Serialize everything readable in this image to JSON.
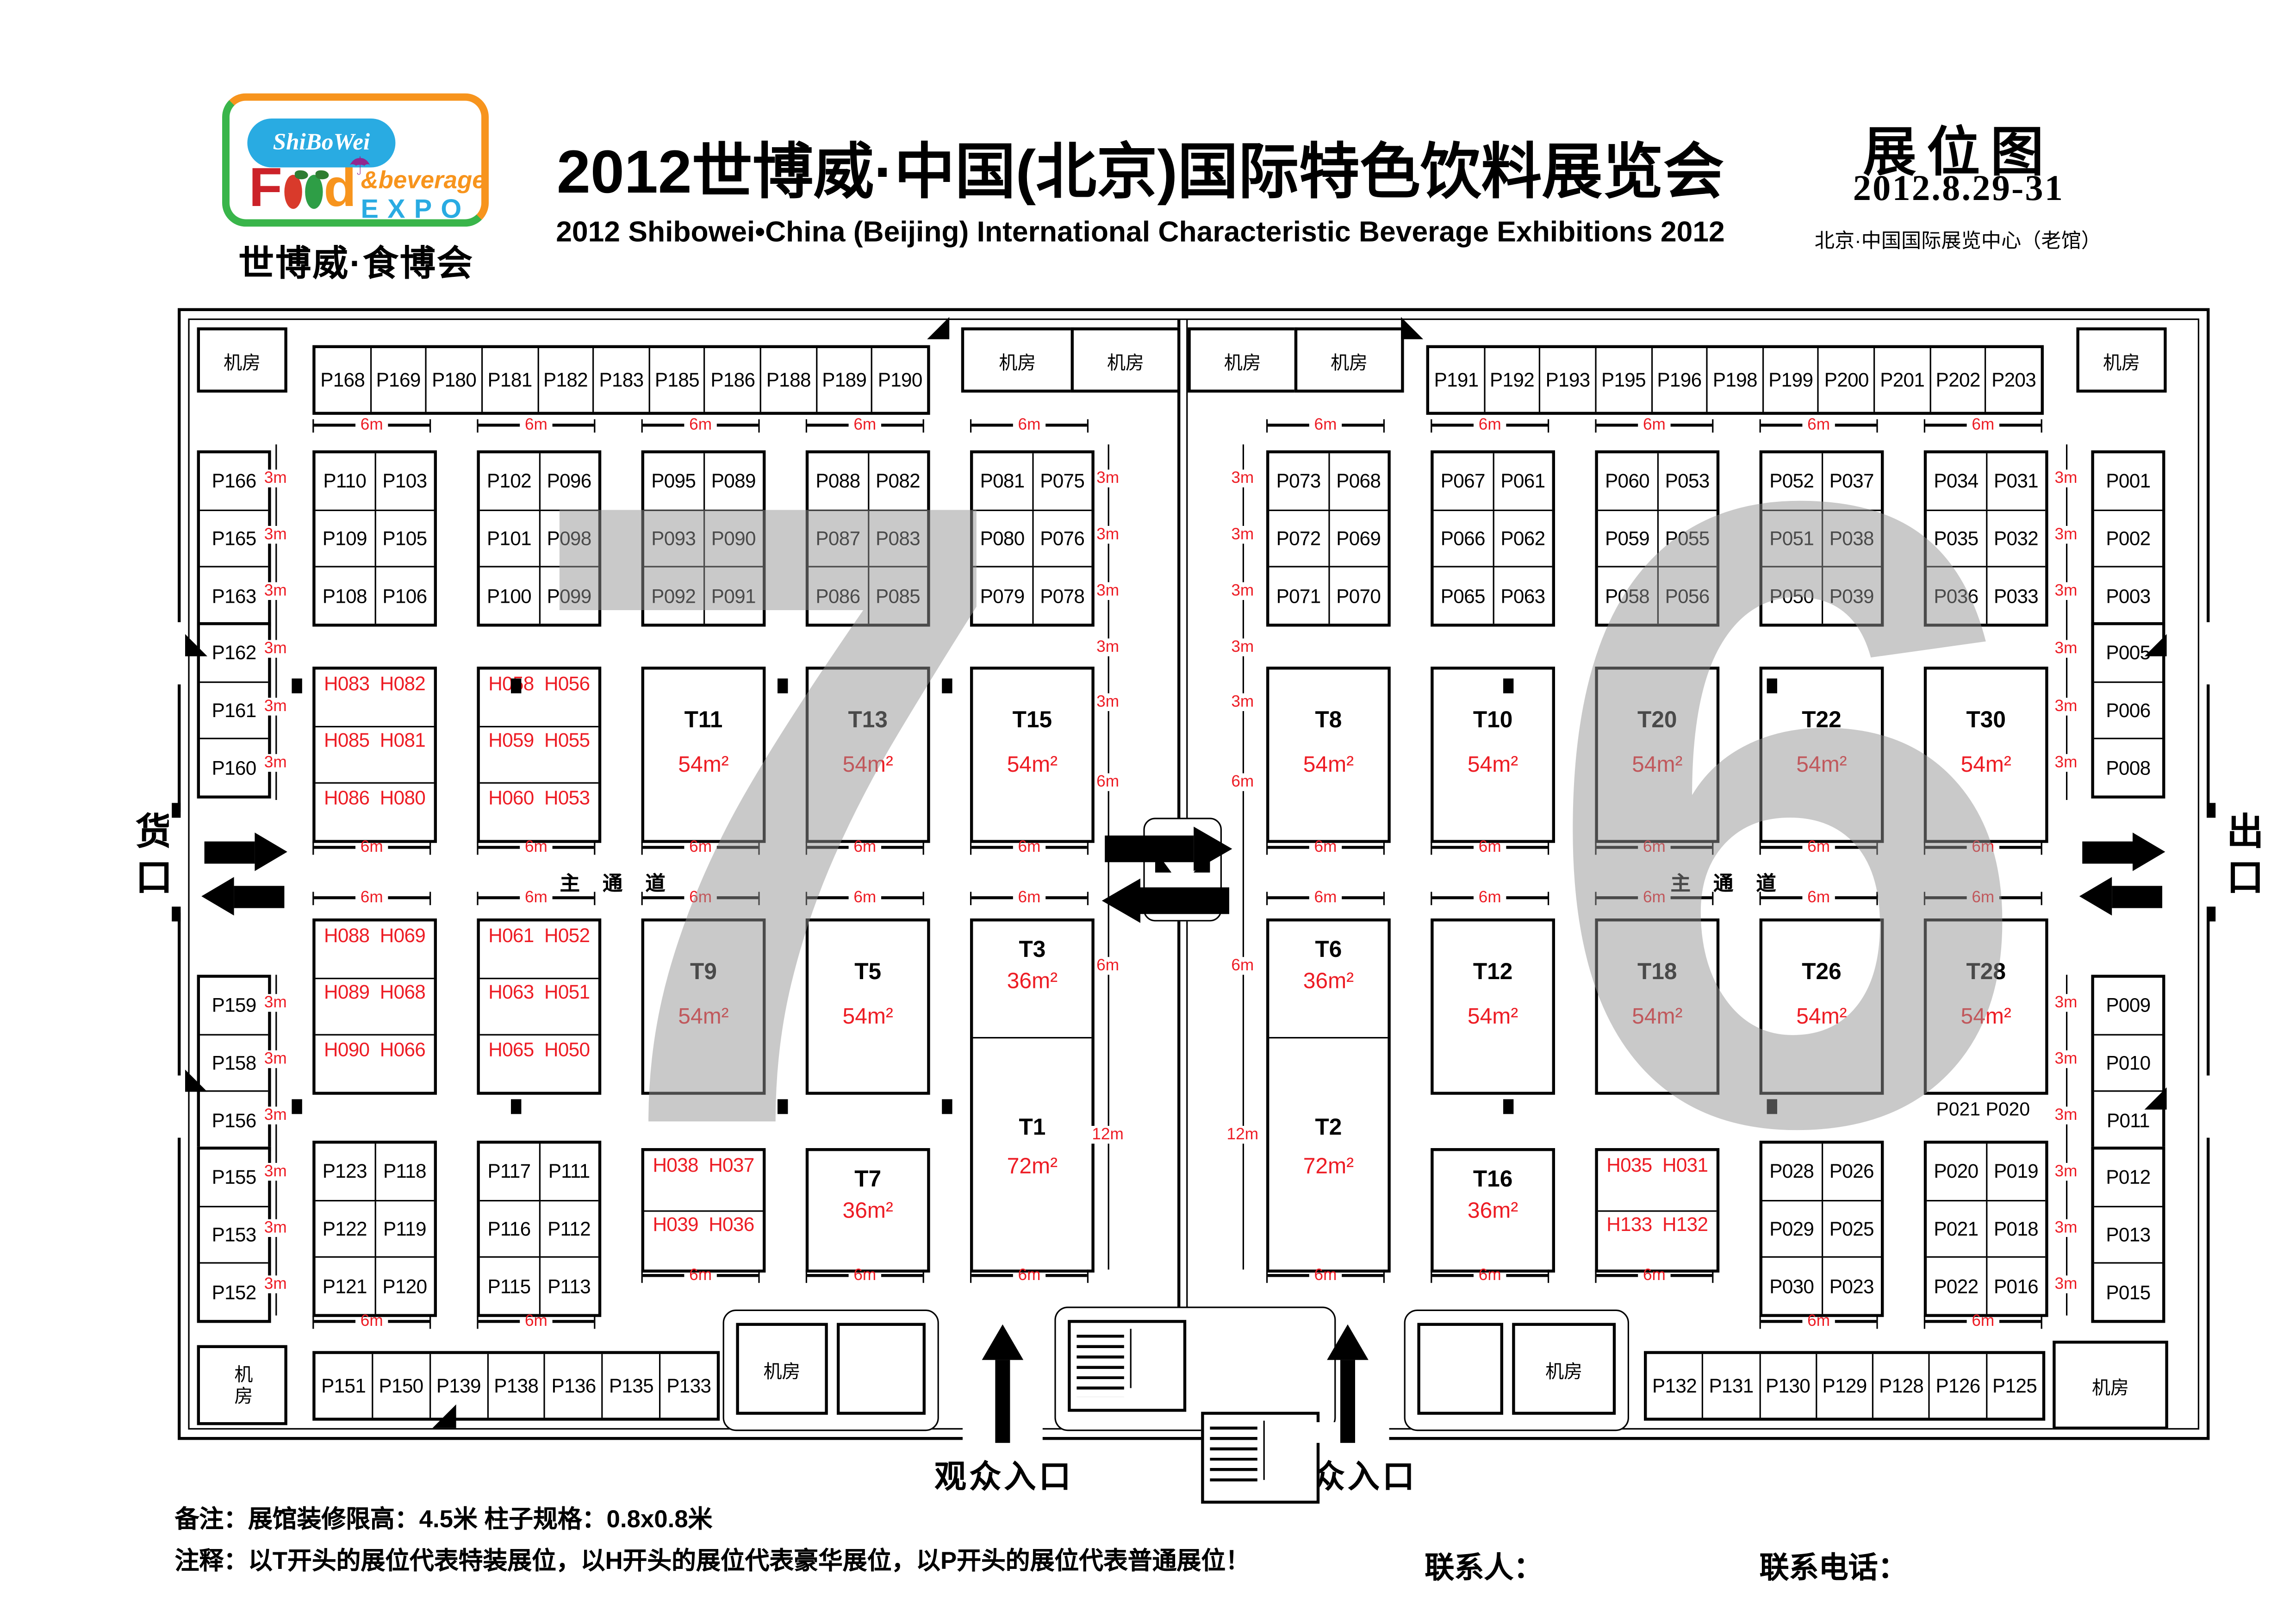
{
  "header": {
    "logo": {
      "script": "ShiBoWei",
      "word_f": "F",
      "word_d": "d",
      "umbrella": "☂",
      "amp_beverage": "&beverage",
      "expo": "EXPO",
      "subtitle": "世博威·食博会"
    },
    "title_cn": "2012世博威·中国(北京)国际特色饮料展览会",
    "title_en": "2012 Shibowei•China (Beijing) International Characteristic Beverage Exhibitions 2012",
    "badge": "展位图",
    "date": "2012.8.29-31",
    "venue": "北京·中国国际展览中心（老馆）"
  },
  "labels": {
    "machine_room": "机房",
    "main_aisle": "主 通 道",
    "cargo_gate": "货口",
    "exit_gate": "出口",
    "visitor_entrance": "观众入口",
    "m3": "3m",
    "m6": "6m",
    "m12": "12m",
    "hall_left": "7",
    "hall_right": "6",
    "floating_right": "P021 P020"
  },
  "notes": {
    "line1": "备注：展馆装修限高：4.5米   柱子规格：0.8x0.8米",
    "line2": "注释：以T开头的展位代表特装展位，以H开头的展位代表豪华展位，以P开头的展位代表普通展位！",
    "contact_person": "联系人：",
    "contact_phone": "联系电话："
  },
  "top_row_left": [
    "P168",
    "P169",
    "P180",
    "P181",
    "P182",
    "P183",
    "P185",
    "P186",
    "P188",
    "P189",
    "P190"
  ],
  "top_row_right": [
    "P191",
    "P192",
    "P193",
    "P195",
    "P196",
    "P198",
    "P199",
    "P200",
    "P201",
    "P202",
    "P203"
  ],
  "bottom_row_left": [
    "P151",
    "P150",
    "P139",
    "P138",
    "P136",
    "P135",
    "P133"
  ],
  "bottom_row_right": [
    "P132",
    "P131",
    "P130",
    "P129",
    "P128",
    "P126",
    "P125"
  ],
  "left_column": {
    "top": [
      "P166",
      "P165",
      "P163"
    ],
    "mid": [
      "P162",
      "P161",
      "P160"
    ],
    "bottom1": [
      "P159",
      "P158",
      "P156"
    ],
    "bottom2": [
      "P155",
      "P153",
      "P152"
    ]
  },
  "right_column": {
    "top": [
      "P001",
      "P002",
      "P003"
    ],
    "mid": [
      "P005",
      "P006",
      "P008"
    ],
    "bottom1": [
      "P009",
      "P010",
      "P011"
    ],
    "bottom2": [
      "P012",
      "P013",
      "P015"
    ]
  },
  "halls": {
    "columns": [
      [
        {
          "kind": "p3",
          "rows": [
            [
              "P110",
              "P103"
            ],
            [
              "P109",
              "P105"
            ],
            [
              "P108",
              "P106"
            ]
          ]
        },
        {
          "kind": "h3",
          "rows": [
            [
              "H083",
              "H082"
            ],
            [
              "H085",
              "H081"
            ],
            [
              "H086",
              "H080"
            ]
          ]
        },
        {
          "kind": "h3",
          "rows": [
            [
              "H088",
              "H069"
            ],
            [
              "H089",
              "H068"
            ],
            [
              "H090",
              "H066"
            ]
          ]
        },
        {
          "kind": "p3",
          "rows": [
            [
              "P123",
              "P118"
            ],
            [
              "P122",
              "P119"
            ],
            [
              "P121",
              "P120"
            ]
          ]
        }
      ],
      [
        {
          "kind": "p3",
          "rows": [
            [
              "P102",
              "P096"
            ],
            [
              "P101",
              "P098"
            ],
            [
              "P100",
              "P099"
            ]
          ]
        },
        {
          "kind": "h3",
          "rows": [
            [
              "H058",
              "H056"
            ],
            [
              "H059",
              "H055"
            ],
            [
              "H060",
              "H053"
            ]
          ]
        },
        {
          "kind": "h3",
          "rows": [
            [
              "H061",
              "H052"
            ],
            [
              "H063",
              "H051"
            ],
            [
              "H065",
              "H050"
            ]
          ]
        },
        {
          "kind": "p3",
          "rows": [
            [
              "P117",
              "P111"
            ],
            [
              "P116",
              "P112"
            ],
            [
              "P115",
              "P113"
            ]
          ]
        }
      ],
      [
        {
          "kind": "p3",
          "rows": [
            [
              "P095",
              "P089"
            ],
            [
              "P093",
              "P090"
            ],
            [
              "P092",
              "P091"
            ]
          ]
        },
        {
          "kind": "t",
          "name": "T11",
          "area": "54m²"
        },
        {
          "kind": "t",
          "name": "T9",
          "area": "54m²"
        },
        {
          "kind": "h2",
          "rows": [
            [
              "H038",
              "H037"
            ],
            [
              "H039",
              "H036"
            ]
          ]
        }
      ],
      [
        {
          "kind": "p3",
          "rows": [
            [
              "P088",
              "P082"
            ],
            [
              "P087",
              "P083"
            ],
            [
              "P086",
              "P085"
            ]
          ]
        },
        {
          "kind": "t",
          "name": "T13",
          "area": "54m²"
        },
        {
          "kind": "t",
          "name": "T5",
          "area": "54m²"
        },
        {
          "kind": "t",
          "name": "T7",
          "area": "36m²"
        }
      ],
      [
        {
          "kind": "p3",
          "rows": [
            [
              "P081",
              "P075"
            ],
            [
              "P080",
              "P076"
            ],
            [
              "P079",
              "P078"
            ]
          ]
        },
        {
          "kind": "t",
          "name": "T15",
          "area": "54m²"
        },
        {
          "kind": "t2",
          "top": {
            "name": "T3",
            "area": "36m²"
          },
          "bottom": {
            "name": "T1",
            "area": "72m²"
          }
        }
      ],
      [
        {
          "kind": "p3",
          "rows": [
            [
              "P073",
              "P068"
            ],
            [
              "P072",
              "P069"
            ],
            [
              "P071",
              "P070"
            ]
          ]
        },
        {
          "kind": "t",
          "name": "T8",
          "area": "54m²"
        },
        {
          "kind": "t2",
          "top": {
            "name": "T6",
            "area": "36m²"
          },
          "bottom": {
            "name": "T2",
            "area": "72m²"
          }
        }
      ],
      [
        {
          "kind": "p3",
          "rows": [
            [
              "P067",
              "P061"
            ],
            [
              "P066",
              "P062"
            ],
            [
              "P065",
              "P063"
            ]
          ]
        },
        {
          "kind": "t",
          "name": "T10",
          "area": "54m²"
        },
        {
          "kind": "t",
          "name": "T12",
          "area": "54m²"
        },
        {
          "kind": "t",
          "name": "T16",
          "area": "36m²"
        }
      ],
      [
        {
          "kind": "p3",
          "rows": [
            [
              "P060",
              "P053"
            ],
            [
              "P059",
              "P055"
            ],
            [
              "P058",
              "P056"
            ]
          ]
        },
        {
          "kind": "t",
          "name": "T20",
          "area": "54m²"
        },
        {
          "kind": "t",
          "name": "T18",
          "area": "54m²"
        },
        {
          "kind": "h2",
          "rows": [
            [
              "H035",
              "H031"
            ],
            [
              "H133",
              "H132"
            ]
          ]
        }
      ],
      [
        {
          "kind": "p3",
          "rows": [
            [
              "P052",
              "P037"
            ],
            [
              "P051",
              "P038"
            ],
            [
              "P050",
              "P039"
            ]
          ]
        },
        {
          "kind": "t",
          "name": "T22",
          "area": "54m²"
        },
        {
          "kind": "t",
          "name": "T26",
          "area": "54m²"
        },
        {
          "kind": "p3",
          "rows": [
            [
              "P028",
              "P026"
            ],
            [
              "P029",
              "P025"
            ],
            [
              "P030",
              "P023"
            ]
          ]
        }
      ],
      [
        {
          "kind": "p3",
          "rows": [
            [
              "P034",
              "P031"
            ],
            [
              "P035",
              "P032"
            ],
            [
              "P036",
              "P033"
            ]
          ]
        },
        {
          "kind": "t",
          "name": "T30",
          "area": "54m²"
        },
        {
          "kind": "t",
          "name": "T28",
          "area": "54m²"
        },
        {
          "kind": "p3",
          "rows": [
            [
              "P020",
              "P019"
            ],
            [
              "P021",
              "P018"
            ],
            [
              "P022",
              "P016"
            ]
          ]
        }
      ]
    ]
  }
}
